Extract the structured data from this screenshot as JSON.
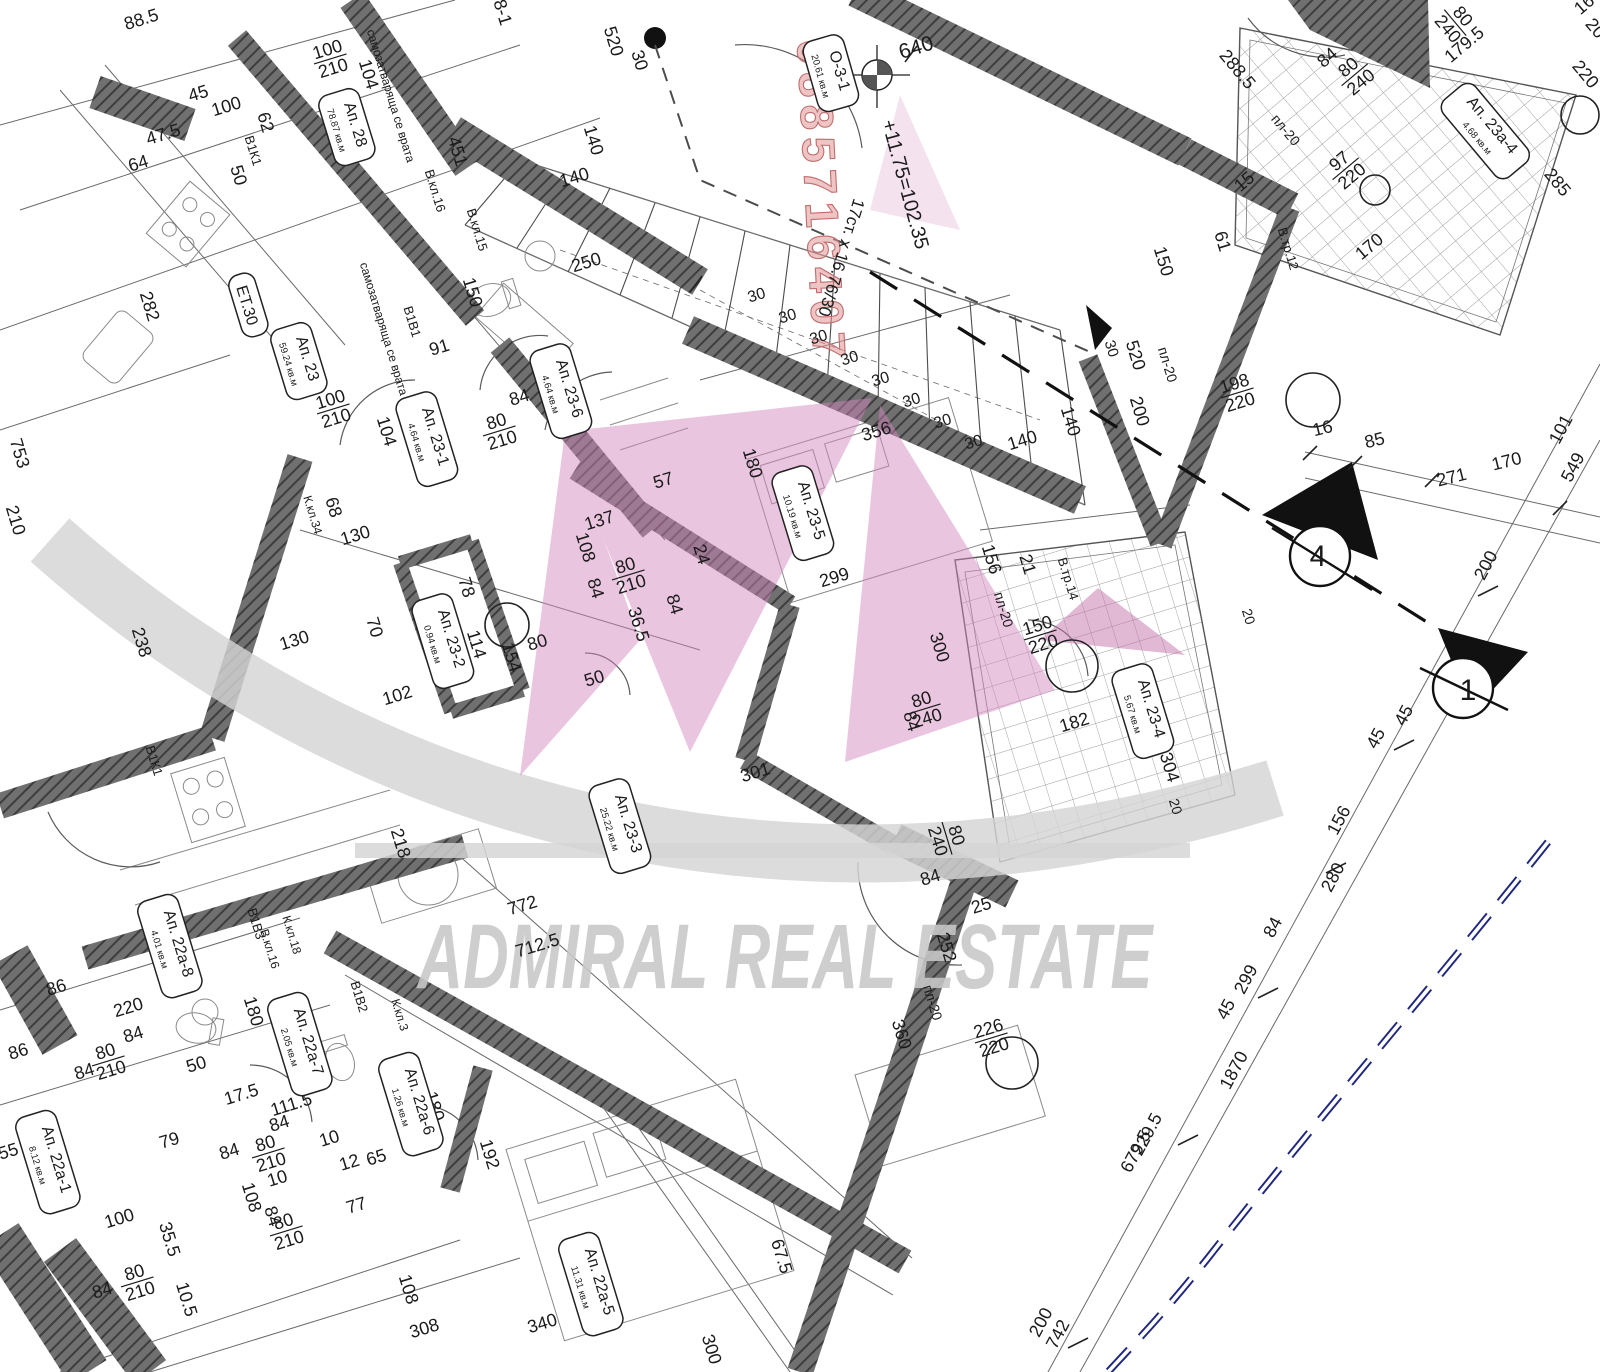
{
  "watermark": {
    "brand": "ADMIRAL REAL ESTATE",
    "phone": "0885716407"
  },
  "section_markers": {
    "marker_a": "4",
    "marker_b": "1"
  },
  "rooms": [
    {
      "name": "О-3-1",
      "area": "20.61 кв.м",
      "x": 828,
      "y": 74,
      "r": 74
    },
    {
      "name": "Ап. 28",
      "area": "78.87 кв.м",
      "x": 344,
      "y": 128,
      "r": 73
    },
    {
      "name": "ЕТ.30",
      "area": "",
      "x": 245,
      "y": 306,
      "r": 73
    },
    {
      "name": "Ап. 23",
      "area": "59.24 кв.м",
      "x": 296,
      "y": 362,
      "r": 73
    },
    {
      "name": "Ап. 23-1",
      "area": "4.64 кв.м",
      "x": 424,
      "y": 440,
      "r": 73
    },
    {
      "name": "Ап. 23-6",
      "area": "4.64 кв.м",
      "x": 558,
      "y": 392,
      "r": 73
    },
    {
      "name": "Ап. 23-2",
      "area": "0.94 кв.м",
      "x": 440,
      "y": 642,
      "r": 73
    },
    {
      "name": "Ап. 23-5",
      "area": "10.19 кв.м",
      "x": 800,
      "y": 514,
      "r": 73
    },
    {
      "name": "Ап. 23-4",
      "area": "5.67 кв.м",
      "x": 1140,
      "y": 712,
      "r": 73
    },
    {
      "name": "Ап. 23-3",
      "area": "25.22 кв.м",
      "x": 617,
      "y": 827,
      "r": 73
    },
    {
      "name": "Ап. 23а-4",
      "area": "4.68 кв.м",
      "x": 1483,
      "y": 133,
      "r": 50
    },
    {
      "name": "Ап. 22а-8",
      "area": "4.01 кв.м",
      "x": 167,
      "y": 947,
      "r": 73
    },
    {
      "name": "Ап. 22а-7",
      "area": "2.05 кв.м",
      "x": 297,
      "y": 1045,
      "r": 73
    },
    {
      "name": "Ап. 22а-6",
      "area": "1.26 кв.м",
      "x": 408,
      "y": 1105,
      "r": 73
    },
    {
      "name": "Ап. 22а-5",
      "area": "11.31 кв.м",
      "x": 588,
      "y": 1285,
      "r": 73
    },
    {
      "name": "Ап. 22а-1",
      "area": "8.12 кв.м",
      "x": 45,
      "y": 1163,
      "r": 73
    }
  ],
  "dims": [
    {
      "t": "88.5",
      "x": 143,
      "y": 25
    },
    {
      "t": "8-1",
      "x": 497,
      "y": 14,
      "r": 73
    },
    {
      "t": "100/210",
      "f": 1,
      "x": 330,
      "y": 58
    },
    {
      "t": "104",
      "x": 363,
      "y": 76,
      "r": 73
    },
    {
      "t": "47.5",
      "x": 165,
      "y": 140
    },
    {
      "t": "64",
      "x": 140,
      "y": 169
    },
    {
      "t": "45",
      "x": 200,
      "y": 99
    },
    {
      "t": "100",
      "x": 228,
      "y": 112
    },
    {
      "t": "62",
      "x": 260,
      "y": 124,
      "r": 73
    },
    {
      "t": "В1К1",
      "x": 249,
      "y": 152,
      "r": 73,
      "s": 13
    },
    {
      "t": "50",
      "x": 233,
      "y": 177,
      "r": 73
    },
    {
      "t": "282",
      "x": 144,
      "y": 308,
      "r": 73
    },
    {
      "t": "753",
      "x": 14,
      "y": 455,
      "r": 73
    },
    {
      "t": "210",
      "x": 10,
      "y": 522,
      "r": 73
    },
    {
      "t": "самозатваряща се врата",
      "x": 387,
      "y": 97,
      "r": 73,
      "s": 12
    },
    {
      "t": "самозатваряща се врата",
      "x": 380,
      "y": 330,
      "r": 73,
      "s": 12
    },
    {
      "t": "В.кл.16",
      "x": 431,
      "y": 192,
      "r": 73,
      "s": 13,
      "c": "#6fa8c0"
    },
    {
      "t": "451",
      "x": 452,
      "y": 153,
      "r": 73
    },
    {
      "t": "В.кл.15",
      "x": 473,
      "y": 231,
      "r": 73,
      "s": 13
    },
    {
      "t": "В1В1",
      "x": 408,
      "y": 323,
      "r": 73,
      "s": 13
    },
    {
      "t": "150",
      "x": 467,
      "y": 294,
      "r": 73
    },
    {
      "t": "91",
      "x": 441,
      "y": 353
    },
    {
      "t": "84",
      "x": 521,
      "y": 403
    },
    {
      "t": "80/210",
      "f": 1,
      "x": 499,
      "y": 430
    },
    {
      "t": "100/210",
      "f": 1,
      "x": 333,
      "y": 408
    },
    {
      "t": "104",
      "x": 381,
      "y": 433,
      "r": 73
    },
    {
      "t": "68",
      "x": 328,
      "y": 509,
      "r": 73
    },
    {
      "t": "К.кл.34",
      "x": 309,
      "y": 516,
      "r": 73,
      "s": 12
    },
    {
      "t": "130",
      "x": 357,
      "y": 541
    },
    {
      "t": "130",
      "x": 296,
      "y": 646
    },
    {
      "t": "238",
      "x": 136,
      "y": 644,
      "r": 73
    },
    {
      "t": "137",
      "x": 601,
      "y": 526
    },
    {
      "t": "108",
      "x": 580,
      "y": 549,
      "r": 73
    },
    {
      "t": "80/210",
      "f": 1,
      "x": 628,
      "y": 574
    },
    {
      "t": "84",
      "x": 590,
      "y": 590,
      "r": 73
    },
    {
      "t": "36.5",
      "x": 633,
      "y": 626,
      "r": 73
    },
    {
      "t": "78",
      "x": 461,
      "y": 589,
      "r": 73
    },
    {
      "t": "70",
      "x": 369,
      "y": 629,
      "r": 73
    },
    {
      "t": "114",
      "x": 471,
      "y": 646,
      "r": 73
    },
    {
      "t": "80",
      "x": 539,
      "y": 648
    },
    {
      "t": "154",
      "x": 506,
      "y": 659,
      "r": 73
    },
    {
      "t": "102",
      "x": 399,
      "y": 701
    },
    {
      "t": "50",
      "x": 596,
      "y": 684
    },
    {
      "t": "140",
      "x": 576,
      "y": 183
    },
    {
      "t": "140",
      "x": 588,
      "y": 142,
      "r": 73
    },
    {
      "t": "250",
      "x": 588,
      "y": 268
    },
    {
      "t": "520",
      "x": 608,
      "y": 43,
      "r": 73
    },
    {
      "t": "30",
      "x": 634,
      "y": 62,
      "r": 73
    },
    {
      "t": "640",
      "x": 918,
      "y": 54,
      "s": 21
    },
    {
      "t": "+11.75=102.35",
      "x": 899,
      "y": 186,
      "r": 75,
      "s": 20
    },
    {
      "t": "17ст. х 16.76/30",
      "x": 836,
      "y": 256,
      "r": 107,
      "s": 17
    },
    {
      "t": "30",
      "x": 758,
      "y": 300,
      "s": 16
    },
    {
      "t": "30",
      "x": 789,
      "y": 321,
      "s": 16
    },
    {
      "t": "30",
      "x": 820,
      "y": 342,
      "s": 16
    },
    {
      "t": "30",
      "x": 851,
      "y": 363,
      "s": 16
    },
    {
      "t": "30",
      "x": 882,
      "y": 384,
      "s": 16
    },
    {
      "t": "30",
      "x": 913,
      "y": 405,
      "s": 16
    },
    {
      "t": "30",
      "x": 944,
      "y": 426,
      "s": 16
    },
    {
      "t": "30",
      "x": 975,
      "y": 447,
      "s": 16
    },
    {
      "t": "150",
      "x": 1158,
      "y": 263,
      "r": 73
    },
    {
      "t": "61",
      "x": 1217,
      "y": 243,
      "r": 73
    },
    {
      "t": "пл-20",
      "x": 1282,
      "y": 133,
      "r": 50,
      "s": 14
    },
    {
      "t": "В.тр.12",
      "x": 1284,
      "y": 250,
      "r": 73,
      "s": 13
    },
    {
      "t": "198/220",
      "f": 1,
      "x": 1237,
      "y": 392
    },
    {
      "t": "520",
      "x": 1130,
      "y": 357,
      "r": 73
    },
    {
      "t": "30",
      "x": 1107,
      "y": 350,
      "r": 73,
      "s": 15
    },
    {
      "t": "пл-20",
      "x": 1163,
      "y": 366,
      "r": 73,
      "s": 14
    },
    {
      "t": "200",
      "x": 1134,
      "y": 413,
      "r": 73
    },
    {
      "t": "140",
      "x": 1065,
      "y": 423,
      "r": 73
    },
    {
      "t": "140",
      "x": 1024,
      "y": 446
    },
    {
      "t": "16",
      "x": 1324,
      "y": 434,
      "r": -14
    },
    {
      "t": "85",
      "x": 1376,
      "y": 446,
      "r": -14
    },
    {
      "t": "271",
      "x": 1453,
      "y": 483,
      "r": -14
    },
    {
      "t": "170",
      "x": 1508,
      "y": 467,
      "r": -14
    },
    {
      "t": "101",
      "x": 1566,
      "y": 432,
      "r": -62
    },
    {
      "t": "549",
      "x": 1578,
      "y": 470,
      "r": -62
    },
    {
      "t": "200",
      "x": 1491,
      "y": 568,
      "r": -62
    },
    {
      "t": "45",
      "x": 1409,
      "y": 718,
      "r": -62
    },
    {
      "t": "45",
      "x": 1381,
      "y": 741,
      "r": -62
    },
    {
      "t": "156",
      "x": 1344,
      "y": 823,
      "r": -62
    },
    {
      "t": "280",
      "x": 1338,
      "y": 880,
      "r": -62
    },
    {
      "t": "84",
      "x": 1278,
      "y": 930,
      "r": -62
    },
    {
      "t": "299",
      "x": 1251,
      "y": 982,
      "r": -62
    },
    {
      "t": "45",
      "x": 1231,
      "y": 1012,
      "r": -62
    },
    {
      "t": "1870",
      "x": 1239,
      "y": 1073,
      "r": -62
    },
    {
      "t": "229.5",
      "x": 1152,
      "y": 1137,
      "r": -62
    },
    {
      "t": "679.5",
      "x": 1141,
      "y": 1154,
      "r": -62
    },
    {
      "t": "200",
      "x": 1046,
      "y": 1325,
      "r": -62
    },
    {
      "t": "742",
      "x": 1063,
      "y": 1337,
      "r": -62
    },
    {
      "t": "356",
      "x": 878,
      "y": 437
    },
    {
      "t": "180",
      "x": 747,
      "y": 465,
      "r": 73
    },
    {
      "t": "57",
      "x": 665,
      "y": 486
    },
    {
      "t": "299",
      "x": 836,
      "y": 583
    },
    {
      "t": "24",
      "x": 696,
      "y": 556,
      "r": 73
    },
    {
      "t": "84",
      "x": 669,
      "y": 606,
      "r": 73
    },
    {
      "t": "156",
      "x": 986,
      "y": 561,
      "r": 73
    },
    {
      "t": "21",
      "x": 1022,
      "y": 566,
      "r": 73
    },
    {
      "t": "пл-20",
      "x": 999,
      "y": 611,
      "r": 73,
      "s": 14
    },
    {
      "t": "300",
      "x": 934,
      "y": 649,
      "r": 73
    },
    {
      "t": "150/220",
      "f": 1,
      "x": 1040,
      "y": 634
    },
    {
      "t": "В.тр.14",
      "x": 1064,
      "y": 580,
      "r": 73,
      "s": 13
    },
    {
      "t": "182",
      "x": 1076,
      "y": 728
    },
    {
      "t": "304",
      "x": 1164,
      "y": 769,
      "r": 73
    },
    {
      "t": "20",
      "x": 1171,
      "y": 808,
      "r": 73,
      "s": 14
    },
    {
      "t": "20",
      "x": 1244,
      "y": 618,
      "r": 73,
      "s": 14
    },
    {
      "t": "80/240",
      "f": 1,
      "x": 924,
      "y": 708
    },
    {
      "t": "84",
      "x": 906,
      "y": 723,
      "r": 73
    },
    {
      "t": "301",
      "x": 757,
      "y": 778
    },
    {
      "t": "772",
      "x": 524,
      "y": 911
    },
    {
      "t": "712.5",
      "x": 539,
      "y": 951
    },
    {
      "t": "218",
      "x": 395,
      "y": 845,
      "r": 73
    },
    {
      "t": "86",
      "x": 58,
      "y": 993
    },
    {
      "t": "86",
      "x": 20,
      "y": 1057
    },
    {
      "t": "220",
      "x": 130,
      "y": 1013
    },
    {
      "t": "84",
      "x": 135,
      "y": 1040
    },
    {
      "t": "80/210",
      "f": 1,
      "x": 108,
      "y": 1060
    },
    {
      "t": "84",
      "x": 86,
      "y": 1077
    },
    {
      "t": "50",
      "x": 198,
      "y": 1070
    },
    {
      "t": "180",
      "x": 248,
      "y": 1013,
      "r": 73
    },
    {
      "t": "В1В3",
      "x": 252,
      "y": 925,
      "r": 73,
      "s": 13
    },
    {
      "t": "В.кл.16",
      "x": 266,
      "y": 950,
      "r": 73,
      "s": 12
    },
    {
      "t": "К.кл.18",
      "x": 288,
      "y": 936,
      "r": 73,
      "s": 12,
      "c": "#c9b942"
    },
    {
      "t": "В1В2",
      "x": 355,
      "y": 998,
      "r": 73,
      "s": 13
    },
    {
      "t": "К.кл.3",
      "x": 396,
      "y": 1016,
      "r": 73,
      "s": 12,
      "c": "#c9b942"
    },
    {
      "t": "В1К1",
      "x": 150,
      "y": 762,
      "r": 73,
      "s": 13
    },
    {
      "t": "17.5",
      "x": 243,
      "y": 1100
    },
    {
      "t": "111.5",
      "x": 293,
      "y": 1110
    },
    {
      "t": "84",
      "x": 281,
      "y": 1129
    },
    {
      "t": "79",
      "x": 171,
      "y": 1146
    },
    {
      "t": "84",
      "x": 231,
      "y": 1157
    },
    {
      "t": "100",
      "x": 121,
      "y": 1224
    },
    {
      "t": "55",
      "x": 10,
      "y": 1157
    },
    {
      "t": "80/210",
      "f": 1,
      "x": 268,
      "y": 1152
    },
    {
      "t": "10",
      "x": 279,
      "y": 1184
    },
    {
      "t": "108",
      "x": 246,
      "y": 1199,
      "r": 73
    },
    {
      "t": "84",
      "x": 267,
      "y": 1218,
      "r": 73
    },
    {
      "t": "80/210",
      "f": 1,
      "x": 286,
      "y": 1230
    },
    {
      "t": "35.5",
      "x": 164,
      "y": 1241,
      "r": 73
    },
    {
      "t": "10.5",
      "x": 181,
      "y": 1301,
      "r": 73
    },
    {
      "t": "80/210",
      "f": 1,
      "x": 137,
      "y": 1281
    },
    {
      "t": "84",
      "x": 104,
      "y": 1296
    },
    {
      "t": "10",
      "x": 331,
      "y": 1144
    },
    {
      "t": "12",
      "x": 351,
      "y": 1168
    },
    {
      "t": "65",
      "x": 378,
      "y": 1163
    },
    {
      "t": "77",
      "x": 358,
      "y": 1211
    },
    {
      "t": "108",
      "x": 403,
      "y": 1291,
      "r": 73
    },
    {
      "t": "180",
      "x": 429,
      "y": 1108,
      "r": 73
    },
    {
      "t": "192",
      "x": 484,
      "y": 1156,
      "r": 73
    },
    {
      "t": "340",
      "x": 544,
      "y": 1329
    },
    {
      "t": "308",
      "x": 426,
      "y": 1334
    },
    {
      "t": "300",
      "x": 706,
      "y": 1351,
      "r": 73
    },
    {
      "t": "67.5",
      "x": 776,
      "y": 1258,
      "r": 73
    },
    {
      "t": "80/240",
      "f": 1,
      "x": 948,
      "y": 838,
      "r": 73
    },
    {
      "t": "84",
      "x": 932,
      "y": 883
    },
    {
      "t": "25",
      "x": 983,
      "y": 911
    },
    {
      "t": "252",
      "x": 941,
      "y": 949,
      "r": 73
    },
    {
      "t": "пл-20",
      "x": 928,
      "y": 1004,
      "r": 73,
      "s": 14
    },
    {
      "t": "360",
      "x": 896,
      "y": 1036,
      "r": 73
    },
    {
      "t": "226/220",
      "f": 1,
      "x": 991,
      "y": 1037
    },
    {
      "t": "84",
      "x": 1331,
      "y": 62,
      "r": -40
    },
    {
      "t": "80/240",
      "f": 1,
      "x": 1354,
      "y": 74,
      "r": -40
    },
    {
      "t": "179.5",
      "x": 1468,
      "y": 49,
      "r": -40
    },
    {
      "t": "80/240",
      "f": 1,
      "x": 1456,
      "y": 22,
      "r": 50
    },
    {
      "t": "285",
      "x": 1553,
      "y": 186,
      "r": 50
    },
    {
      "t": "97/220",
      "f": 1,
      "x": 1345,
      "y": 168,
      "r": -40
    },
    {
      "t": "170",
      "x": 1373,
      "y": 251,
      "r": -40
    },
    {
      "t": "288.5",
      "x": 1233,
      "y": 73,
      "r": 50
    },
    {
      "t": "15",
      "x": 1248,
      "y": 186,
      "r": -40
    },
    {
      "t": "220",
      "x": 1581,
      "y": 78,
      "r": 50
    },
    {
      "t": "16",
      "x": 1588,
      "y": 9,
      "r": -40
    },
    {
      "t": "20",
      "x": 1591,
      "y": 32,
      "r": 50
    }
  ]
}
